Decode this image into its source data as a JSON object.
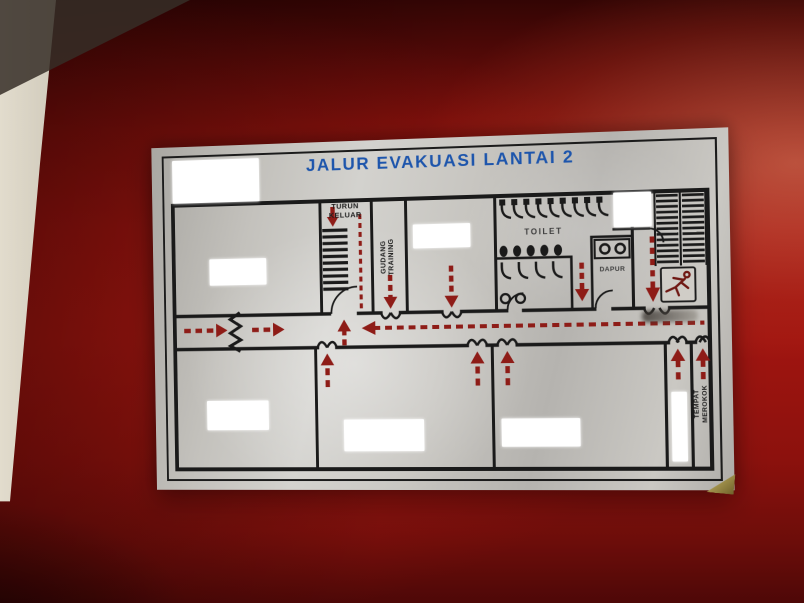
{
  "sign": {
    "title": "JALUR EVAKUASI LANTAI 2",
    "labels": {
      "stairs_exit": "TURUN\nKELUAR",
      "storage": "GUDANG\nTRAINING",
      "toilet": "TOILET",
      "kitchen": "DAPUR",
      "smoking_area": "TEMPAT\nMEROKOK"
    },
    "colors": {
      "door_red": "#9c130f",
      "wall_beige": "#d6d0c2",
      "sign_silver": "#c6c4bf",
      "title_blue": "#1d55ac",
      "plan_line": "#1a1a1a",
      "route_arrow_red": "#8e1c17"
    }
  }
}
